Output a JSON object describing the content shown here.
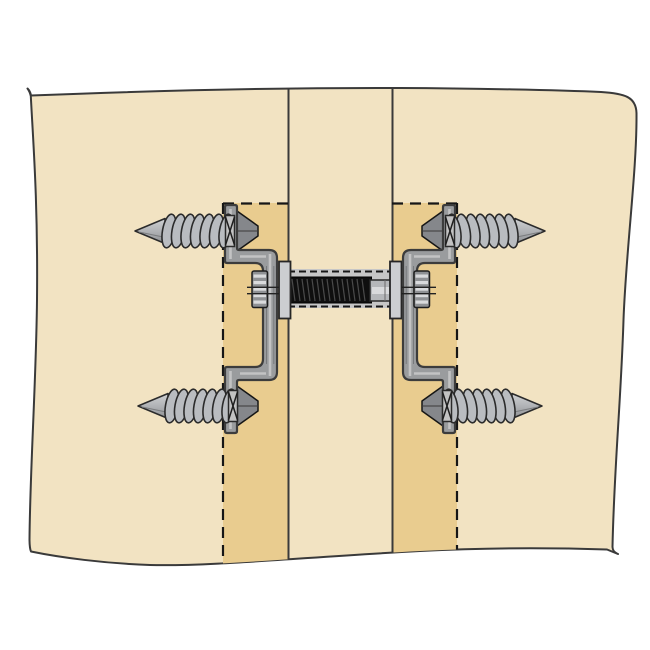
{
  "illustration": {
    "type": "technical-line-drawing",
    "subject": "knock-down panel connector cross-section with four lag screws, two C-brackets and a central threaded draw rod",
    "text_labels": []
  },
  "colors": {
    "background": "#ffffff",
    "panel": "#f2e3c2",
    "recess": "#e9cc8f",
    "outline": "#3a3a3a",
    "lineDark": "#161616",
    "bracket": "#9a9c9e",
    "bracketHighlight": "#cacaca",
    "bracketStroke": "#3c3c3c",
    "countersink": "#85878b",
    "steelLight": "#d9dadc",
    "steelMid": "#b5b7ba",
    "steelBody": "#8f9194",
    "coil": "#b9bcc0",
    "coilStroke": "#2b2b2b",
    "core": "#9fa1a3",
    "rod": "#0f0f0f",
    "rodThread": "#4a4a4a",
    "flange": "#ccced1",
    "channel": "#c6c6c6"
  },
  "components": {
    "panel": "wood panel shown with torn wavy edges",
    "joint": "two vertical joint lines forming the centre panel edge",
    "recesses": [
      "left routed recess (hidden outline dashed)",
      "right routed recess (hidden outline dashed)"
    ],
    "screws": [
      "lag-screw-top-left",
      "lag-screw-bottom-left",
      "lag-screw-top-right",
      "lag-screw-bottom-right"
    ],
    "brackets": [
      "left C-bracket",
      "right C-bracket"
    ],
    "center_assembly": [
      "left ribbed tension nut",
      "left flange plate",
      "threaded draw rod",
      "rod sleeve",
      "right flange plate",
      "right ribbed tension nut"
    ]
  }
}
